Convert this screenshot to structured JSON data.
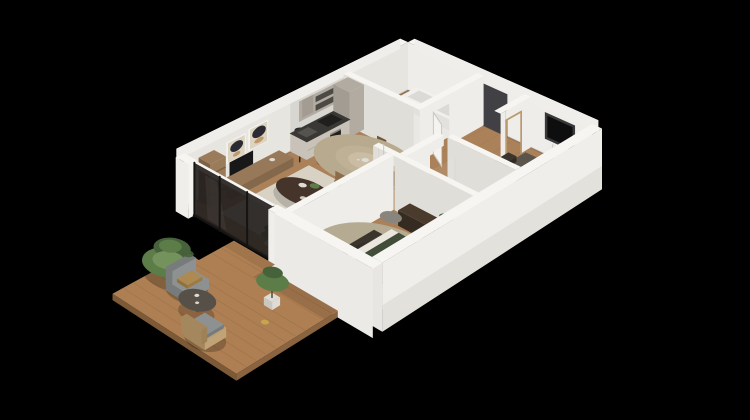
{
  "scene": {
    "type": "isometric-3d-floorplan-render",
    "description": "3D isometric cutaway render of a furnished two-bedroom apartment with terrace, viewed from above on a black background",
    "background": "#000000"
  },
  "palette": {
    "bg": "#000000",
    "wallCap": "#f6f5f2",
    "wallOuter": "#efeeea",
    "wallOuterLow": "#e3e1dc",
    "wallInner": "#e7e5e0",
    "wallInnerLit": "#efede9",
    "wallShade": "#e0ded8",
    "wallTexture": "#cfccc5",
    "floorWood": "#ab8159",
    "floorWoodLine": "#8f6a47",
    "bathFloor": "#e9e8e4",
    "showerFloor": "#b7b6b3",
    "rugLiving": "#d8d2c5",
    "rugRound": "#e7e0d1",
    "rugB2": "#9a9184",
    "deckWood": "#ae7f52",
    "deckLine": "#936b44",
    "deckEdge": "#7c5a38",
    "glass": "#24211e",
    "mullion": "#161412",
    "sofa": "#cbc8c0",
    "sofaShade": "#b3b0a8",
    "throw": "#e5decf",
    "coffeeTable": "#44342a",
    "coffeeTableDark": "#30241c",
    "diningTop": "#cfc3ab",
    "diningEdge": "#b7aa8e",
    "chairWood": "#8c6c4a",
    "chairWoodDark": "#73563a",
    "kitchenTall": "#b2aba1",
    "kitchenTallShade": "#a39c92",
    "kitchenLow": "#c8c2b8",
    "counterDark": "#3a3834",
    "ovenDark": "#211f1e",
    "shelfWood": "#9b7c5a",
    "shelfWoodDark": "#7d6144",
    "consoleWood": "#97795a",
    "consoleShade": "#84684c",
    "tvBlack": "#181818",
    "artPaper": "#ddd3c1",
    "artDark": "#2b2a32",
    "artTan": "#c1996c",
    "doorDark": "#414145",
    "doorFrame": "#b99a6c",
    "windowBlack": "#0e0e0e",
    "windowFrame": "#39393c",
    "radiator": "#ecebe8",
    "white": "#f4f3f0",
    "whiteShade": "#e3e1dc",
    "tub": "#f1f0ed",
    "tubInner": "#dbdad6",
    "bedGreen": "#414c39",
    "bedGreenDark": "#333d2c",
    "bedRust": "#7a4330",
    "bedRustDark": "#693a29",
    "pillowDark": "#39352d",
    "sheet": "#eae6dd",
    "bed2Blanket": "#5a544b",
    "bed2BlanketDark": "#48433b",
    "bed2Pillow": "#d8d0bd",
    "mattress": "#e9e6df",
    "headboard": "#35302a",
    "benchDark": "#3a342d",
    "benchDarker": "#2f2a24",
    "sideboard": "#362b21",
    "sideboardTop": "#4a3b2d",
    "plantGreen": "#5c7c48",
    "plantDark": "#46623a",
    "plantLight": "#74925c",
    "potWhite": "#dedcd6",
    "armGray": "#8e9192",
    "armGrayDark": "#787b7c",
    "cushionOchre": "#ad8a52",
    "rattan": "#c0a377",
    "rattanDark": "#a5875e",
    "tableDark": "#565049",
    "stoolWood": "#9a7850",
    "pouf": "#8a857c"
  },
  "rooms": [
    {
      "id": "apartment-shell",
      "label": "Apartment shell",
      "items": [
        "wood-floor",
        "exterior-walls",
        "wall-art",
        "tv",
        "tv-console",
        "bookshelf",
        "floor-lamp",
        "entrance-door",
        "window",
        "radiator"
      ]
    },
    {
      "id": "bathroom",
      "label": "Bathroom",
      "items": [
        "bathtub",
        "toilet",
        "bathroom-door"
      ]
    },
    {
      "id": "kitchen",
      "label": "Kitchen",
      "items": [
        "tall-cabinet",
        "counter-run",
        "cooktop",
        "sink",
        "oven",
        "open-shelves",
        "bar-stool"
      ]
    },
    {
      "id": "dining-area",
      "label": "Dining area",
      "items": [
        "round-dining-table",
        "dining-chairs",
        "centerpiece"
      ]
    },
    {
      "id": "bedroom-2",
      "label": "Bedroom 2",
      "items": [
        "double-bed",
        "pillows",
        "bench",
        "rug",
        "door-frame"
      ]
    },
    {
      "id": "shower-room",
      "label": "Shower room",
      "items": [
        "walk-in-shower",
        "glass-screen",
        "vanity",
        "plant"
      ]
    },
    {
      "id": "hallway",
      "label": "Hallway",
      "items": [
        "master-bedroom-door"
      ]
    },
    {
      "id": "living-room",
      "label": "Living room",
      "items": [
        "sofa",
        "coffee-table",
        "area-rug",
        "decor",
        "potted-plant",
        "pampas-vase"
      ]
    },
    {
      "id": "master-bedroom",
      "label": "Master bedroom",
      "items": [
        "double-bed",
        "round-rug",
        "sideboard",
        "plant",
        "bench",
        "pouf"
      ]
    },
    {
      "id": "terrace",
      "label": "Terrace",
      "items": [
        "wood-deck",
        "lounge-armchair",
        "rattan-armchair",
        "round-side-table",
        "large-plant",
        "potted-tree",
        "lantern"
      ]
    }
  ]
}
